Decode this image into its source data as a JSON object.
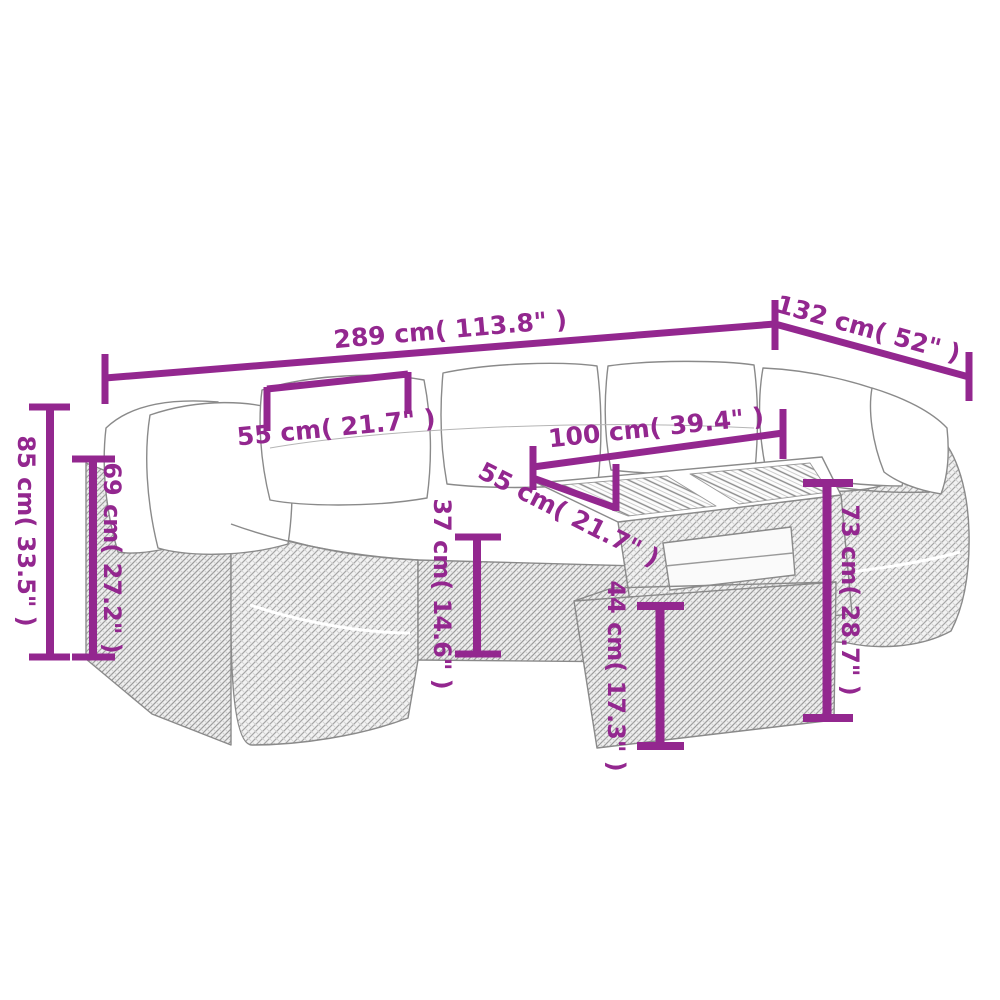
{
  "diagram": {
    "type": "product-dimension-diagram",
    "subject": "poly-rattan garden lounge set with cushions, wood-top table and footstool",
    "background_color": "#ffffff",
    "dimension_color": "#93278F",
    "outline_color": "#8a8a8a",
    "measurements": [
      {
        "id": "overall-width",
        "cm": 289,
        "inch": 113.8,
        "label": "289 cm( 113.8\" )"
      },
      {
        "id": "overall-depth",
        "cm": 132,
        "inch": 52,
        "label": "132 cm( 52\" )"
      },
      {
        "id": "seat-module-width",
        "cm": 55,
        "inch": 21.7,
        "label": "55 cm( 21.7\" )"
      },
      {
        "id": "overall-height",
        "cm": 85,
        "inch": 33.5,
        "label": "85 cm( 33.5\" )"
      },
      {
        "id": "backrest-height",
        "cm": 69,
        "inch": 27.2,
        "label": "69 cm( 27.2\" )"
      },
      {
        "id": "table-length",
        "cm": 100,
        "inch": 39.4,
        "label": "100 cm( 39.4\" )"
      },
      {
        "id": "table-depth",
        "cm": 55,
        "inch": 21.7,
        "label": "55 cm( 21.7\" )"
      },
      {
        "id": "seat-height",
        "cm": 37,
        "inch": 14.6,
        "label": "37 cm( 14.6\" )"
      },
      {
        "id": "table-height",
        "cm": 73,
        "inch": 28.7,
        "label": "73 cm( 28.7\" )"
      },
      {
        "id": "footstool-height",
        "cm": 44,
        "inch": 17.3,
        "label": "44 cm( 17.3\" )"
      }
    ]
  }
}
